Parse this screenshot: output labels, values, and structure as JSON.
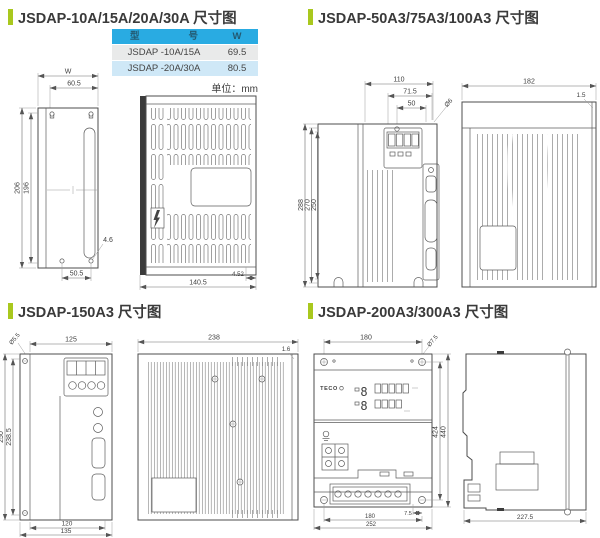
{
  "titles": {
    "q1": "JSDAP-10A/15A/20A/30A 尺寸图",
    "q2": "JSDAP-50A3/75A3/100A3 尺寸图",
    "q3": "JSDAP-150A3 尺寸图",
    "q4": "JSDAP-200A3/300A3 尺寸图"
  },
  "colors": {
    "accent_green": "#a9c81e",
    "table_header_bg": "#29abe2",
    "row_gray": "#e9eaea",
    "row_blue": "#cfe8f7"
  },
  "table": {
    "header_model_left": "型",
    "header_model_right": "号",
    "header_w": "W",
    "rows": [
      {
        "model": "JSDAP -10A/15A",
        "w": "69.5"
      },
      {
        "model": "JSDAP -20A/30A",
        "w": "80.5"
      }
    ],
    "unit_note": "单位：mm"
  },
  "q1": {
    "back": {
      "w_label": "W",
      "hook_span": "60.5",
      "h_outer": "206",
      "h_inner": "196",
      "hole_dia": "4.6",
      "hole_span": "50.5"
    },
    "side": {
      "depth": "140.5",
      "lip": "4.52"
    }
  },
  "q2": {
    "front": {
      "top_w": "110",
      "mid_w": "71.5",
      "hole_span": "50",
      "hole_dia": "Ø6",
      "h_outer": "288",
      "h_mount": "270",
      "h_body": "250"
    },
    "side": {
      "depth": "182",
      "plate": "1.5"
    }
  },
  "q3": {
    "front": {
      "hole_dia": "Ø5.5",
      "top_w": "125",
      "h_outer": "250",
      "h_mount": "238.5",
      "bottom_inner": "120",
      "bottom_outer": "135"
    },
    "side": {
      "depth": "238",
      "plate": "1.6"
    }
  },
  "q4": {
    "front": {
      "top_span": "180",
      "hole_dia": "Ø7.5",
      "h_mount": "424",
      "h_outer": "440",
      "off": "7.5",
      "bottom_span": "180",
      "bottom_outer": "252",
      "brand": "TECO",
      "display": "8"
    },
    "side": {
      "depth": "227.5"
    }
  }
}
